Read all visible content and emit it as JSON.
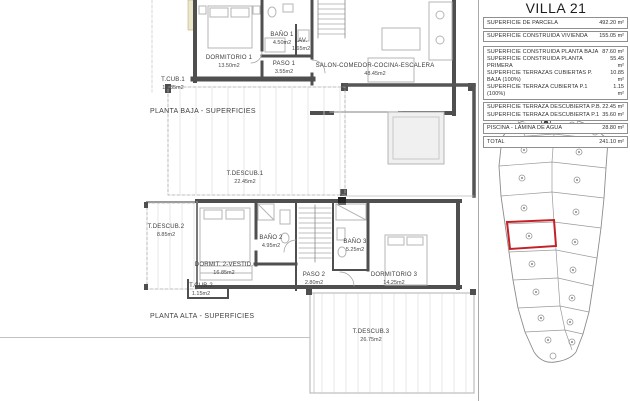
{
  "header": {
    "title": "VILLA 21"
  },
  "areas_table": {
    "groups": [
      {
        "rows": [
          {
            "label": "SUPERFICIE DE PARCELA",
            "value": "492.20 m²"
          }
        ]
      },
      {
        "rows": [
          {
            "label": "SUPERFICIE CONSTRUIDA VIVIENDA",
            "value": "155.05 m²"
          }
        ]
      },
      {
        "rows": [
          {
            "label": "SUPERFICIE CONSTRUIDA PLANTA BAJA",
            "value": "87.60 m²"
          },
          {
            "label": "SUPERFICIE CONSTRUIDA PLANTA PRIMERA",
            "value": "55.45 m²"
          },
          {
            "label": "SUPERFICIE TERRAZAS CUBIERTAS P. BAJA (100%)",
            "value": "10.85 m²"
          },
          {
            "label": "SUPERFICIE TERRAZA CUBIERTA P.1 (100%)",
            "value": "1.15 m²"
          }
        ]
      },
      {
        "rows": [
          {
            "label": "SUPERFICIE TERRAZA DESCUBIERTA P.B.",
            "value": "22.45 m²"
          },
          {
            "label": "SUPERFICIE TERRAZA DESCUBIERTA P.1",
            "value": "35.60 m²"
          }
        ]
      },
      {
        "rows": [
          {
            "label": "PISCINA - LÁMINA DE AGUA",
            "value": "28.80 m²"
          }
        ]
      },
      {
        "rows": [
          {
            "label": "TOTAL",
            "value": "241.10 m²"
          }
        ]
      }
    ]
  },
  "planta_baja": {
    "title": "PLANTA BAJA - SUPERFICIES",
    "rooms": {
      "dormitorio1": {
        "name": "DORMITORIO 1",
        "area": "13.50m2"
      },
      "bano1": {
        "name": "BAÑO 1",
        "area": "4.50m2"
      },
      "lav": {
        "name": "LAV.",
        "area": "1.65m2"
      },
      "paso1": {
        "name": "PASO 1",
        "area": "3.55m2"
      },
      "salon": {
        "name": "SALON-COMEDOR-COCINA-ESCALERA",
        "area": "48.45m2"
      },
      "tcub1": {
        "name": "T.CUB.1",
        "area": "10.85m2"
      },
      "tdescub1": {
        "name": "T.DESCUB.1",
        "area": "22.45m2"
      }
    }
  },
  "planta_alta": {
    "title": "PLANTA ALTA - SUPERFICIES",
    "rooms": {
      "tdescub2": {
        "name": "T.DESCUB.2",
        "area": "8.85m2"
      },
      "dormit2": {
        "name": "DORMIT. 2-VESTID.",
        "area": "16.85m2"
      },
      "bano2": {
        "name": "BAÑO 2",
        "area": "4.95m2"
      },
      "tcub2": {
        "name": "T.CUB.2",
        "area": "1.15m2"
      },
      "paso2": {
        "name": "PASO 2",
        "area": "2.80m2"
      },
      "bano3": {
        "name": "BAÑO 3",
        "area": "5.25m2"
      },
      "dormitorio3": {
        "name": "DORMITORIO 3",
        "area": "14.25m2"
      },
      "tdescub3": {
        "name": "T.DESCUB.3",
        "area": "26.75m2"
      }
    }
  },
  "site_plan": {
    "highlighted_plot": "VILLA 21",
    "colors": {
      "highlight": "#c42127",
      "wall": "#4f4f4f",
      "insulation": "#ece7c9"
    }
  }
}
